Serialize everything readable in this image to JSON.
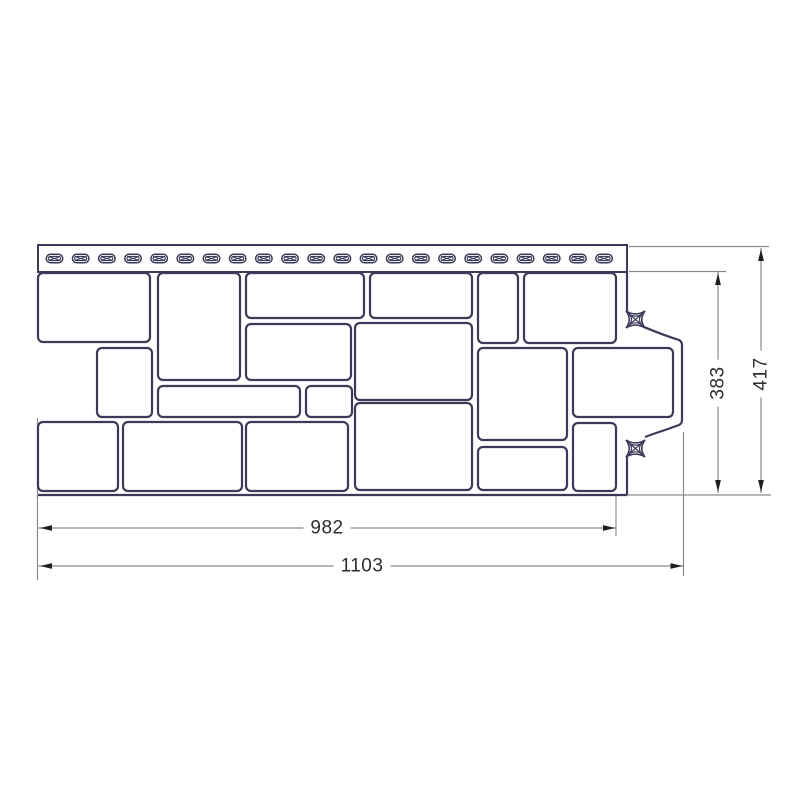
{
  "diagram_data": {
    "type": "technical_drawing",
    "subject": "facade-siding-panel-front-view",
    "dimension_labels": {
      "inner_width": "982",
      "outer_width": "1103",
      "inner_height": "383",
      "outer_height": "417"
    },
    "colors": {
      "background": "#ffffff",
      "panel_outline": "#3b3b58",
      "dimension_line": "#8a8a8a",
      "arrowhead": "#1f1f1f",
      "label_text": "#2d2d2d"
    },
    "panel": {
      "nail_strip": {
        "x": 38,
        "y": 245,
        "w": 589,
        "h": 27
      },
      "slots": {
        "count": 22,
        "start_cx": 54.5,
        "pitch": 26.17,
        "cy": 258.5,
        "w": 16.5,
        "h": 8.5
      },
      "blocks": [
        [
          38,
          273,
          112,
          69
        ],
        [
          158,
          273,
          82,
          107
        ],
        [
          246,
          273,
          118,
          45
        ],
        [
          370,
          273,
          102,
          45
        ],
        [
          478,
          273,
          40,
          70
        ],
        [
          524,
          273,
          92,
          70
        ],
        [
          97,
          348,
          55,
          69
        ],
        [
          246,
          324,
          105,
          56
        ],
        [
          355,
          323,
          117,
          77
        ],
        [
          478,
          348,
          89,
          92
        ],
        [
          573,
          348,
          100,
          69
        ],
        [
          158,
          386,
          142,
          31
        ],
        [
          306,
          386,
          46,
          31
        ],
        [
          38,
          422,
          80,
          69
        ],
        [
          123,
          422,
          119,
          69
        ],
        [
          246,
          422,
          102,
          69
        ],
        [
          355,
          403,
          117,
          87
        ],
        [
          478,
          447,
          89,
          43
        ],
        [
          573,
          423,
          43,
          68
        ]
      ],
      "right_edge_segments": [
        "M627,271 L627,311",
        "M644,327 C656,332 663,335 679,340 Q682,341.5 682,345 L682,420 Q682,423.5 679,425 L665,430 C656,433 650,435 645,437",
        "M627,456 L627,495"
      ],
      "fastener_marks": [
        [
          626,
          311,
          19,
          17
        ],
        [
          626,
          440,
          19,
          17
        ]
      ],
      "bottom_edge": [
        38,
        495,
        627,
        495
      ]
    },
    "dimension_lines": [
      [
        38.5,
        528,
        616.5,
        528
      ],
      [
        38.5,
        566,
        684,
        566
      ],
      [
        718,
        272,
        718,
        493
      ],
      [
        761,
        248,
        761,
        493
      ]
    ],
    "extension_lines": [
      [
        37.5,
        418,
        37.5,
        580
      ],
      [
        616,
        495,
        616,
        536
      ],
      [
        683.5,
        432,
        683.5,
        576
      ],
      [
        629,
        246.5,
        769,
        246.5
      ],
      [
        629,
        271.5,
        726,
        271.5
      ],
      [
        627,
        495,
        771,
        495
      ]
    ],
    "arrows": [
      [
        40,
        528,
        "left"
      ],
      [
        615,
        528,
        "right"
      ],
      [
        40,
        566,
        "left"
      ],
      [
        682.5,
        566,
        "right"
      ],
      [
        718,
        273,
        "up"
      ],
      [
        718,
        492,
        "down"
      ],
      [
        761,
        249,
        "up"
      ],
      [
        761,
        492,
        "down"
      ]
    ],
    "label_positions": {
      "inner_width": [
        327,
        528
      ],
      "outer_width": [
        362,
        566
      ],
      "inner_height": [
        718,
        383
      ],
      "outer_height": [
        761,
        374
      ]
    }
  }
}
